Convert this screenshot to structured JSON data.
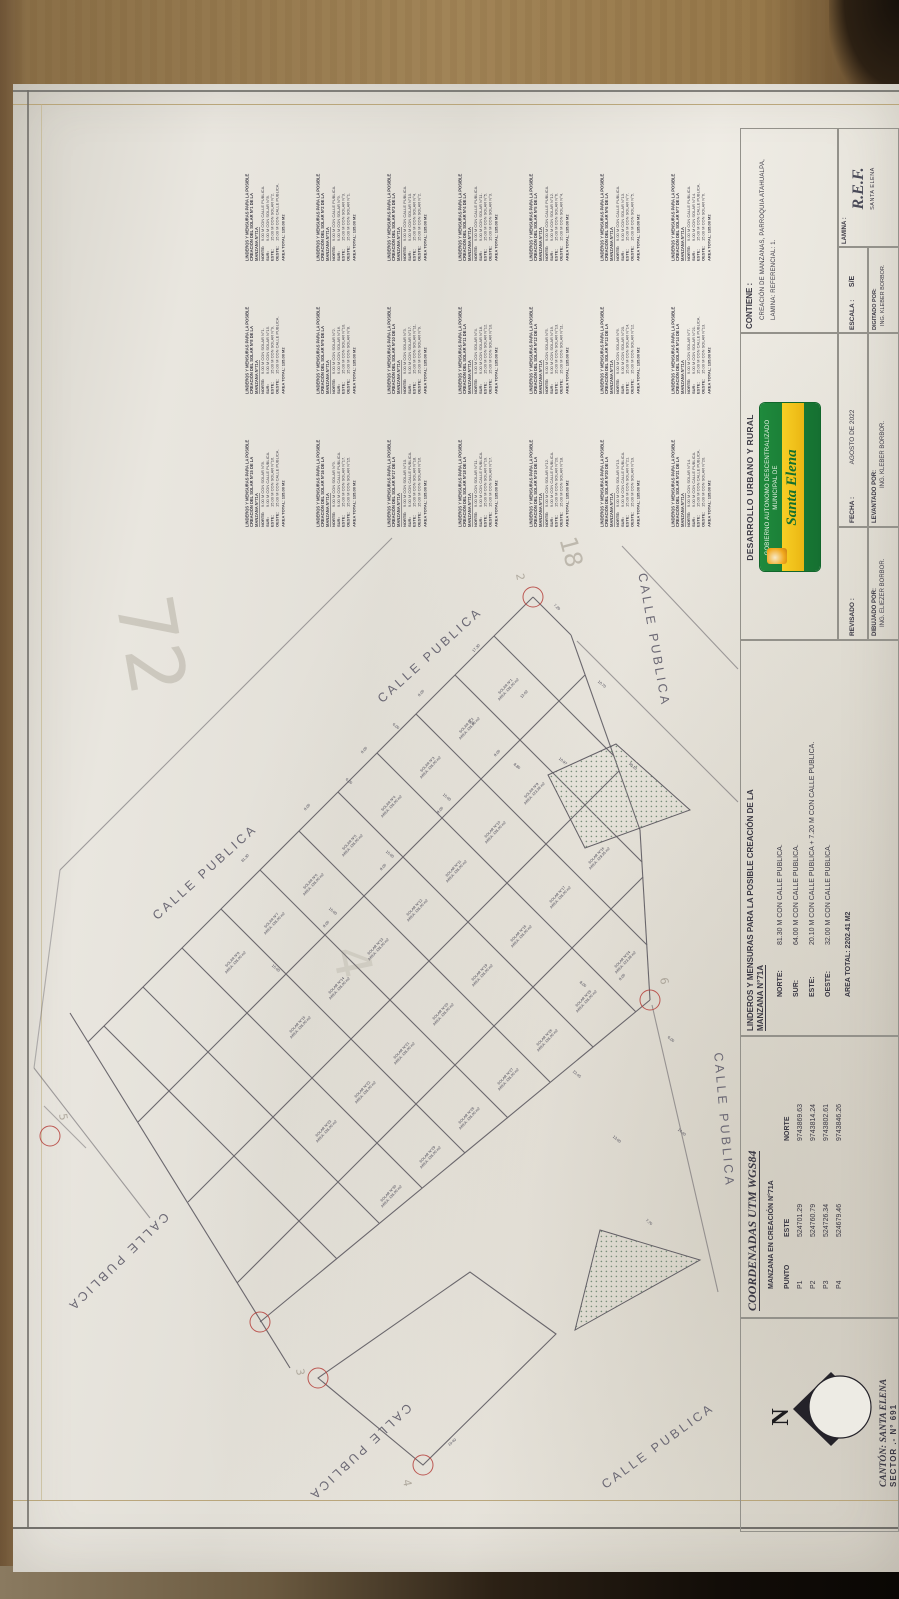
{
  "title_blocks": {
    "lamina": {
      "label": "LAMINA :",
      "value": "R.E.F.",
      "sub": "SANTA ELENA"
    },
    "contiene": {
      "label": "CONTIENE :",
      "line1": "CREACIÓN DE MANZANAS, PARROQUIA ATAHUALPA,",
      "line2": "LAMINA: REFERENCIAL: 1."
    },
    "escala": {
      "label": "ESCALA :",
      "value": "S/E"
    },
    "digitado": {
      "label": "DIGITADO POR:",
      "value": "ING. KLEBER BORBOR."
    },
    "departamento": {
      "title": "DESARROLLO URBANO Y RURAL"
    },
    "logo": {
      "org": "GOBIERNO AUTONOMO DESCENTRALIZADO MUNICIPAL DE",
      "name": "Santa Elena"
    },
    "fecha": {
      "label": "FECHA :",
      "value": "AGOSTO DE 2022"
    },
    "levantado": {
      "label": "LEVANTADO POR:",
      "value": "ING. KLEBER BORBOR."
    },
    "revisado": {
      "label": "REVISADO :"
    },
    "dibujado": {
      "label": "DIBUJADO POR:",
      "value": "ING. ELIEZER BORBOR."
    },
    "linderos_manzana": {
      "title_line1": "LINDEROS Y MENSURAS PARA LA POSIBLE CREACIÓN DE LA",
      "title_line2": "MANZANA N°71A",
      "rows": [
        [
          "NORTE:",
          "81.30 M CON CALLE PUBLICA."
        ],
        [
          "SUR:",
          "64.00 M CON CALLE PUBLICA."
        ],
        [
          "ESTE:",
          "20.10 M CON CALLE PUBLICA + 7.20 M CON CALLE PUBLICA."
        ],
        [
          "OESTE:",
          "32.00 M CON CALLE PUBLICA."
        ]
      ],
      "area": "AREA TOTAL: 2202.41 M2"
    },
    "coordenadas": {
      "title": "COORDENADAS UTM WGS84",
      "subtitle": "MANZANA EN CREACIÓN N°71A",
      "headers": [
        "PUNTO",
        "ESTE",
        "NORTE"
      ],
      "rows": [
        [
          "P1",
          "524701.29",
          "9743869.63"
        ],
        [
          "P2",
          "524760.79",
          "9743814.24"
        ],
        [
          "P3",
          "524726.34",
          "9743802.61"
        ],
        [
          "P4",
          "524679.46",
          "9743846.26"
        ]
      ]
    },
    "canton": {
      "line1": "CANTÓN: SANTA ELENA",
      "line2": "SECTOR  .-  N° 691"
    }
  },
  "linderos_solares": {
    "header_line1": "LINDEROS Y MENSURAS PARA LA POSIBLE",
    "header_line2": "CREACIÓN DEL SOLAR N°{n} DE LA",
    "header_line3": "MANZANA N°71A",
    "entries": [
      {
        "n": 1,
        "norte": "9.00 M CON CALLE PUBLICA.",
        "sur": "9.00 M CON SOLAR N°8.",
        "este": "15.00 M CON SOLAR N°2.",
        "oeste": "15.00 M CON CALLE PUBLICA.",
        "area": "AREA TOTAL: 135.00 M2"
      },
      {
        "n": 2,
        "norte": "9.00 M CON CALLE PUBLICA.",
        "sur": "9.00 M CON SOLAR N°9.",
        "este": "15.00 M CON SOLAR N°3.",
        "oeste": "15.00 M CON SOLAR N°1.",
        "area": "AREA TOTAL: 135.00 M2"
      },
      {
        "n": 3,
        "norte": "9.00 M CON CALLE PUBLICA.",
        "sur": "9.00 M CON SOLAR N°10.",
        "este": "15.00 M CON SOLAR N°4.",
        "oeste": "15.00 M CON SOLAR N°2.",
        "area": "AREA TOTAL: 135.00 M2"
      },
      {
        "n": 4,
        "norte": "9.00 M CON CALLE PUBLICA.",
        "sur": "9.00 M CON SOLAR N°11.",
        "este": "15.00 M CON SOLAR N°5.",
        "oeste": "15.00 M CON SOLAR N°3.",
        "area": "AREA TOTAL: 135.00 M2"
      },
      {
        "n": 5,
        "norte": "9.00 M CON CALLE PUBLICA.",
        "sur": "9.00 M CON SOLAR N°12.",
        "este": "15.00 M CON SOLAR N°6.",
        "oeste": "15.00 M CON SOLAR N°4.",
        "area": "AREA TOTAL: 135.00 M2"
      },
      {
        "n": 6,
        "norte": "9.00 M CON CALLE PUBLICA.",
        "sur": "9.00 M CON SOLAR N°13.",
        "este": "15.00 M CON SOLAR N°7.",
        "oeste": "15.00 M CON SOLAR N°5.",
        "area": "AREA TOTAL: 135.00 M2"
      },
      {
        "n": 7,
        "norte": "9.00 M CON CALLE PUBLICA.",
        "sur": "9.00 M CON SOLAR N°14.",
        "este": "15.00 M CON CALLE PUBLICA.",
        "oeste": "15.00 M CON SOLAR N°6.",
        "area": "AREA TOTAL: 135.00 M2"
      },
      {
        "n": 8,
        "norte": "9.00 M CON SOLAR N°1.",
        "sur": "9.00 M CON SOLAR N°15.",
        "este": "15.00 M CON SOLAR N°9.",
        "oeste": "15.00 M CON CALLE PUBLICA.",
        "area": "AREA TOTAL: 135.00 M2"
      },
      {
        "n": 9,
        "norte": "9.00 M CON SOLAR N°2.",
        "sur": "9.00 M CON SOLAR N°16.",
        "este": "15.00 M CON SOLAR N°10.",
        "oeste": "15.00 M CON SOLAR N°8.",
        "area": "AREA TOTAL: 135.00 M2"
      },
      {
        "n": 10,
        "norte": "9.00 M CON SOLAR N°3.",
        "sur": "9.00 M CON SOLAR N°17.",
        "este": "15.00 M CON SOLAR N°11.",
        "oeste": "15.00 M CON SOLAR N°9.",
        "area": "AREA TOTAL: 135.00 M2"
      },
      {
        "n": 11,
        "norte": "9.00 M CON SOLAR N°4.",
        "sur": "9.00 M CON SOLAR N°18.",
        "este": "15.00 M CON SOLAR N°12.",
        "oeste": "15.00 M CON SOLAR N°10.",
        "area": "AREA TOTAL: 135.00 M2"
      },
      {
        "n": 12,
        "norte": "9.00 M CON SOLAR N°5.",
        "sur": "9.00 M CON SOLAR N°19.",
        "este": "15.00 M CON SOLAR N°13.",
        "oeste": "15.00 M CON SOLAR N°11.",
        "area": "AREA TOTAL: 135.00 M2"
      },
      {
        "n": 13,
        "norte": "9.00 M CON SOLAR N°6.",
        "sur": "9.00 M CON SOLAR N°20.",
        "este": "15.00 M CON SOLAR N°14.",
        "oeste": "15.00 M CON SOLAR N°12.",
        "area": "AREA TOTAL: 135.00 M2"
      },
      {
        "n": 14,
        "norte": "9.00 M CON SOLAR N°7.",
        "sur": "9.00 M CON SOLAR N°21.",
        "este": "15.00 M CON CALLE PUBLICA.",
        "oeste": "15.00 M CON SOLAR N°13.",
        "area": "AREA TOTAL: 135.00 M2"
      },
      {
        "n": 15,
        "norte": "9.00 M CON SOLAR N°8.",
        "sur": "9.00 M CON CALLE PUBLICA.",
        "este": "15.00 M CON SOLAR N°16.",
        "oeste": "15.00 M CON CALLE PUBLICA.",
        "area": "AREA TOTAL: 135.00 M2"
      },
      {
        "n": 16,
        "norte": "9.00 M CON SOLAR N°9.",
        "sur": "9.00 M CON CALLE PUBLICA.",
        "este": "15.00 M CON SOLAR N°17.",
        "oeste": "15.00 M CON SOLAR N°15.",
        "area": "AREA TOTAL: 135.00 M2"
      },
      {
        "n": 17,
        "norte": "9.00 M CON SOLAR N°10.",
        "sur": "9.00 M CON CALLE PUBLICA.",
        "este": "15.00 M CON SOLAR N°18.",
        "oeste": "15.00 M CON SOLAR N°16.",
        "area": "AREA TOTAL: 135.00 M2"
      },
      {
        "n": 18,
        "norte": "9.00 M CON SOLAR N°11.",
        "sur": "9.00 M CON CALLE PUBLICA.",
        "este": "15.00 M CON SOLAR N°19.",
        "oeste": "15.00 M CON SOLAR N°17.",
        "area": "AREA TOTAL: 135.00 M2"
      },
      {
        "n": 19,
        "norte": "9.00 M CON SOLAR N°12.",
        "sur": "9.00 M CON CALLE PUBLICA.",
        "este": "15.00 M CON SOLAR N°20.",
        "oeste": "15.00 M CON SOLAR N°18.",
        "area": "AREA TOTAL: 135.00 M2"
      },
      {
        "n": 20,
        "norte": "9.00 M CON SOLAR N°13.",
        "sur": "9.00 M CON CALLE PUBLICA.",
        "este": "15.00 M CON SOLAR N°21.",
        "oeste": "15.00 M CON SOLAR N°19.",
        "area": "AREA TOTAL: 135.00 M2"
      },
      {
        "n": 21,
        "norte": "9.00 M CON SOLAR N°14.",
        "sur": "9.00 M CON CALLE PUBLICA.",
        "este": "15.00 M CON CALLE PUBLICA.",
        "oeste": "15.00 M CON SOLAR N°20.",
        "area": "AREA TOTAL: 135.00 M2"
      }
    ]
  },
  "map": {
    "streets": [
      {
        "t": "CALLE  PUBLICA",
        "x": 205,
        "y": 872,
        "r": -42
      },
      {
        "t": "CALLE  PUBLICA",
        "x": 430,
        "y": 655,
        "r": -42
      },
      {
        "t": "CALLE  PUBLICA",
        "x": 654,
        "y": 640,
        "r": 80
      },
      {
        "t": "CALLE  PUBLICA",
        "x": 724,
        "y": 1120,
        "r": 85
      },
      {
        "t": "CALLE  PUBLICA",
        "x": 118,
        "y": 1262,
        "r": 136
      },
      {
        "t": "CALLE  PUBLICA",
        "x": 360,
        "y": 1452,
        "r": 137
      },
      {
        "t": "CALLE  PUBLICA",
        "x": 658,
        "y": 1446,
        "r": -36
      }
    ],
    "lots": [
      {
        "n": "SOLAR N°1",
        "a": "AREA: 135.00 m2",
        "x": 507,
        "y": 688
      },
      {
        "n": "SOLAR N°2",
        "a": "AREA: 135.00 m2",
        "x": 468,
        "y": 727
      },
      {
        "n": "SOLAR N°3",
        "a": "AREA: 135.00 m2",
        "x": 429,
        "y": 766
      },
      {
        "n": "SOLAR N°4",
        "a": "AREA: 135.00 m2",
        "x": 390,
        "y": 805
      },
      {
        "n": "SOLAR N°5",
        "a": "AREA: 135.00 m2",
        "x": 351,
        "y": 844
      },
      {
        "n": "SOLAR N°6",
        "a": "AREA: 135.00 m2",
        "x": 312,
        "y": 883
      },
      {
        "n": "SOLAR N°7",
        "a": "AREA: 135.00 m2",
        "x": 273,
        "y": 922
      },
      {
        "n": "SOLAR N°8",
        "a": "AREA: 135.00 m2",
        "x": 234,
        "y": 961
      },
      {
        "n": "SOLAR N°9",
        "a": "AREA: 123.38 m2",
        "x": 533,
        "y": 792
      },
      {
        "n": "SOLAR N°10",
        "a": "AREA: 135.00 m2",
        "x": 494,
        "y": 831
      },
      {
        "n": "SOLAR N°11",
        "a": "AREA: 135.00 m2",
        "x": 455,
        "y": 870
      },
      {
        "n": "SOLAR N°12",
        "a": "AREA: 135.00 m2",
        "x": 416,
        "y": 909
      },
      {
        "n": "SOLAR N°13",
        "a": "AREA: 135.00 m2",
        "x": 377,
        "y": 948
      },
      {
        "n": "SOLAR N°14",
        "a": "AREA: 135.00 m2",
        "x": 338,
        "y": 987
      },
      {
        "n": "SOLAR N°15",
        "a": "AREA: 135.00 m2",
        "x": 299,
        "y": 1026
      },
      {
        "n": "SOLAR N°16",
        "a": "AREA: 129.35 m2",
        "x": 598,
        "y": 857
      },
      {
        "n": "SOLAR N°17",
        "a": "AREA: 135.00 m2",
        "x": 559,
        "y": 896
      },
      {
        "n": "SOLAR N°18",
        "a": "AREA: 135.00 m2",
        "x": 520,
        "y": 935
      },
      {
        "n": "SOLAR N°19",
        "a": "AREA: 135.00 m2",
        "x": 481,
        "y": 974
      },
      {
        "n": "SOLAR N°20",
        "a": "AREA: 135.00 m2",
        "x": 442,
        "y": 1013
      },
      {
        "n": "SOLAR N°21",
        "a": "AREA: 135.00 m2",
        "x": 403,
        "y": 1052
      },
      {
        "n": "SOLAR N°22",
        "a": "AREA: 135.00 m2",
        "x": 364,
        "y": 1091
      },
      {
        "n": "SOLAR N°23",
        "a": "AREA: 135.00 m2",
        "x": 325,
        "y": 1130
      },
      {
        "n": "SOLAR N°24",
        "a": "AREA: 123.38 m2",
        "x": 624,
        "y": 961
      },
      {
        "n": "SOLAR N°25",
        "a": "AREA: 135.00 m2",
        "x": 585,
        "y": 1000
      },
      {
        "n": "SOLAR N°26",
        "a": "AREA: 135.00 m2",
        "x": 546,
        "y": 1039
      },
      {
        "n": "SOLAR N°27",
        "a": "AREA: 135.00 m2",
        "x": 507,
        "y": 1078
      },
      {
        "n": "SOLAR N°28",
        "a": "AREA: 135.00 m2",
        "x": 468,
        "y": 1117
      },
      {
        "n": "SOLAR N°29",
        "a": "AREA: 135.00 m2",
        "x": 429,
        "y": 1156
      },
      {
        "n": "SOLAR N°30",
        "a": "AREA: 135.00 m2",
        "x": 390,
        "y": 1195
      }
    ],
    "dims": [
      {
        "t": "81.30",
        "x": 245,
        "y": 858,
        "r": -46
      },
      {
        "t": "8.00",
        "x": 421,
        "y": 693,
        "r": -46
      },
      {
        "t": "8.00",
        "x": 364,
        "y": 750,
        "r": -46
      },
      {
        "t": "8.00",
        "x": 307,
        "y": 807,
        "r": -46
      },
      {
        "t": "17.30",
        "x": 476,
        "y": 648,
        "r": -46
      },
      {
        "t": "7.20",
        "x": 557,
        "y": 607,
        "r": 42
      },
      {
        "t": "10.70",
        "x": 602,
        "y": 684,
        "r": 40
      },
      {
        "t": "30.10",
        "x": 633,
        "y": 766,
        "r": 40
      },
      {
        "t": "13.02",
        "x": 524,
        "y": 694,
        "r": -46
      },
      {
        "t": "8.80",
        "x": 517,
        "y": 766,
        "r": 40
      },
      {
        "t": "10.97",
        "x": 563,
        "y": 761,
        "r": 40
      },
      {
        "t": "7.20",
        "x": 471,
        "y": 722,
        "r": 40
      },
      {
        "t": "6.00",
        "x": 396,
        "y": 726,
        "r": 40
      },
      {
        "t": "6.00",
        "x": 349,
        "y": 781,
        "r": 40
      },
      {
        "t": "15.00",
        "x": 447,
        "y": 797,
        "r": 40
      },
      {
        "t": "15.00",
        "x": 390,
        "y": 854,
        "r": 40
      },
      {
        "t": "15.00",
        "x": 333,
        "y": 911,
        "r": 40
      },
      {
        "t": "15.00",
        "x": 276,
        "y": 968,
        "r": 40
      },
      {
        "t": "9.00",
        "x": 497,
        "y": 753,
        "r": -46
      },
      {
        "t": "9.00",
        "x": 440,
        "y": 810,
        "r": -46
      },
      {
        "t": "9.00",
        "x": 383,
        "y": 867,
        "r": -46
      },
      {
        "t": "9.00",
        "x": 326,
        "y": 924,
        "r": -46
      },
      {
        "t": "8.00",
        "x": 583,
        "y": 984,
        "r": 40
      },
      {
        "t": "8.00",
        "x": 622,
        "y": 977,
        "r": -46
      },
      {
        "t": "6.00",
        "x": 671,
        "y": 1039,
        "r": 40
      },
      {
        "t": "22.45",
        "x": 577,
        "y": 1074,
        "r": 40
      },
      {
        "t": "13.00",
        "x": 617,
        "y": 1139,
        "r": 40
      },
      {
        "t": "14.40",
        "x": 682,
        "y": 1132,
        "r": 40
      },
      {
        "t": "7.70",
        "x": 649,
        "y": 1222,
        "r": 40
      },
      {
        "t": "19.40",
        "x": 452,
        "y": 1442,
        "r": -40
      }
    ],
    "vertices": [
      {
        "x": 533,
        "y": 597,
        "n": "2",
        "nx": 520,
        "ny": 577
      },
      {
        "x": 650,
        "y": 1000,
        "n": "6",
        "nx": 664,
        "ny": 981
      },
      {
        "x": 423,
        "y": 1465,
        "n": "4",
        "nx": 407,
        "ny": 1483
      },
      {
        "x": 318,
        "y": 1378,
        "n": "3",
        "nx": 300,
        "ny": 1372
      },
      {
        "x": 260,
        "y": 1322,
        "n": "",
        "nx": 0,
        "ny": 0
      },
      {
        "x": 50,
        "y": 1136,
        "n": "5",
        "nx": 63,
        "ny": 1117
      }
    ],
    "pencil": [
      {
        "t": "72",
        "x": 150,
        "y": 645,
        "r": 80,
        "s": 78,
        "o": 0.32
      },
      {
        "t": "18",
        "x": 571,
        "y": 552,
        "r": 75,
        "s": 24,
        "o": 0.5
      },
      {
        "t": "4",
        "x": 352,
        "y": 962,
        "r": 78,
        "s": 50,
        "o": 0.2
      }
    ]
  }
}
